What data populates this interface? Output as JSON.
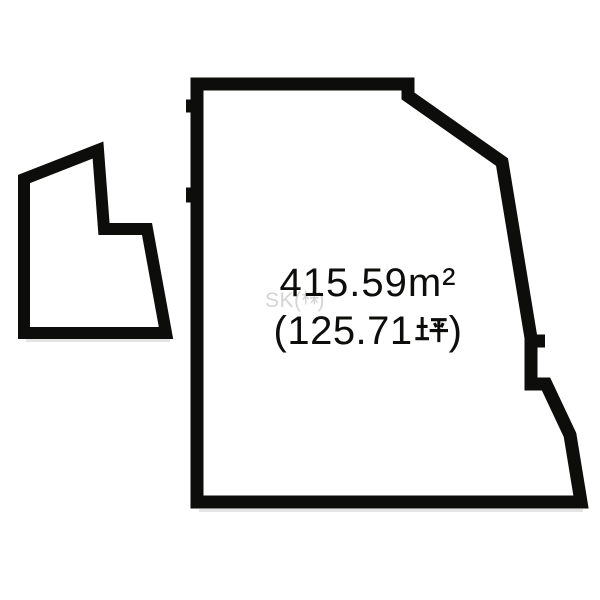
{
  "canvas": {
    "width": 600,
    "height": 600,
    "background": "#ffffff"
  },
  "colors": {
    "outline": "#0d0d0b",
    "text": "#0d0d0b",
    "parcel_fill": "#ffffff",
    "watermark": "#d4d4d4",
    "scan_shadow": "#e4e4e4"
  },
  "area_label": {
    "m2": "415.59m²",
    "tsubo_open": "(125.71",
    "tsubo_unit": "坪",
    "tsubo_close": ")",
    "tsubo_full": "(125.71坪)"
  },
  "watermark": {
    "prefix": "SK(",
    "kanji": "株",
    "suffix": ")",
    "full": "SK(株)"
  },
  "shapes": {
    "main_plot": {
      "type": "polygon",
      "closed": true,
      "stroke_width": 13,
      "points": [
        [
          197,
          84
        ],
        [
          408,
          84
        ],
        [
          408,
          96
        ],
        [
          502,
          162
        ],
        [
          531,
          338
        ],
        [
          531,
          384
        ],
        [
          546,
          384
        ],
        [
          570,
          435
        ],
        [
          581,
          502
        ],
        [
          197,
          502
        ]
      ]
    },
    "left_parcel": {
      "type": "polygon",
      "closed": true,
      "stroke_width": 12,
      "points": [
        [
          98,
          150
        ],
        [
          104,
          229
        ],
        [
          147,
          229
        ],
        [
          166,
          333
        ],
        [
          24,
          333
        ],
        [
          24,
          179
        ]
      ]
    },
    "boundary_jogs": [
      {
        "type": "line",
        "stroke_width": 13,
        "points": [
          [
            186,
            106
          ],
          [
            198,
            106
          ]
        ]
      },
      {
        "type": "line",
        "stroke_width": 15,
        "points": [
          [
            186,
            195
          ],
          [
            198,
            195
          ]
        ]
      },
      {
        "type": "line",
        "stroke_width": 13,
        "points": [
          [
            531,
            341
          ],
          [
            545,
            341
          ]
        ]
      }
    ],
    "scan_shadows": [
      {
        "type": "line",
        "stroke_width": 3,
        "points": [
          [
            199,
            510.5
          ],
          [
            583,
            510.5
          ]
        ]
      },
      {
        "type": "line",
        "stroke_width": 3,
        "points": [
          [
            26,
            340.5
          ],
          [
            170,
            340.5
          ]
        ]
      }
    ]
  }
}
